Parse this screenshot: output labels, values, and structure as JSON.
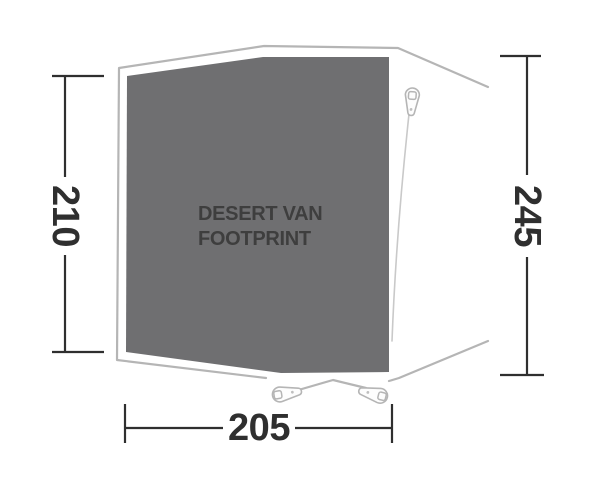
{
  "diagram": {
    "product_label": {
      "line1": "DESERT VAN",
      "line2": "FOOTPRINT"
    },
    "dimensions": {
      "left_height": "210",
      "right_height": "245",
      "bottom_width": "205"
    },
    "icons": {
      "top_right_peg": "tent-peg-icon",
      "bottom_left_peg": "tent-peg-icon",
      "bottom_right_peg": "tent-peg-icon"
    },
    "colors": {
      "fabric_fill": "#6f6f71",
      "outline_gray": "#b5b5b5",
      "guy_line_gray": "#c9c9c9",
      "dimension_line": "#2f2f2f",
      "label_text": "#3e3e3e",
      "background": "#ffffff"
    }
  }
}
